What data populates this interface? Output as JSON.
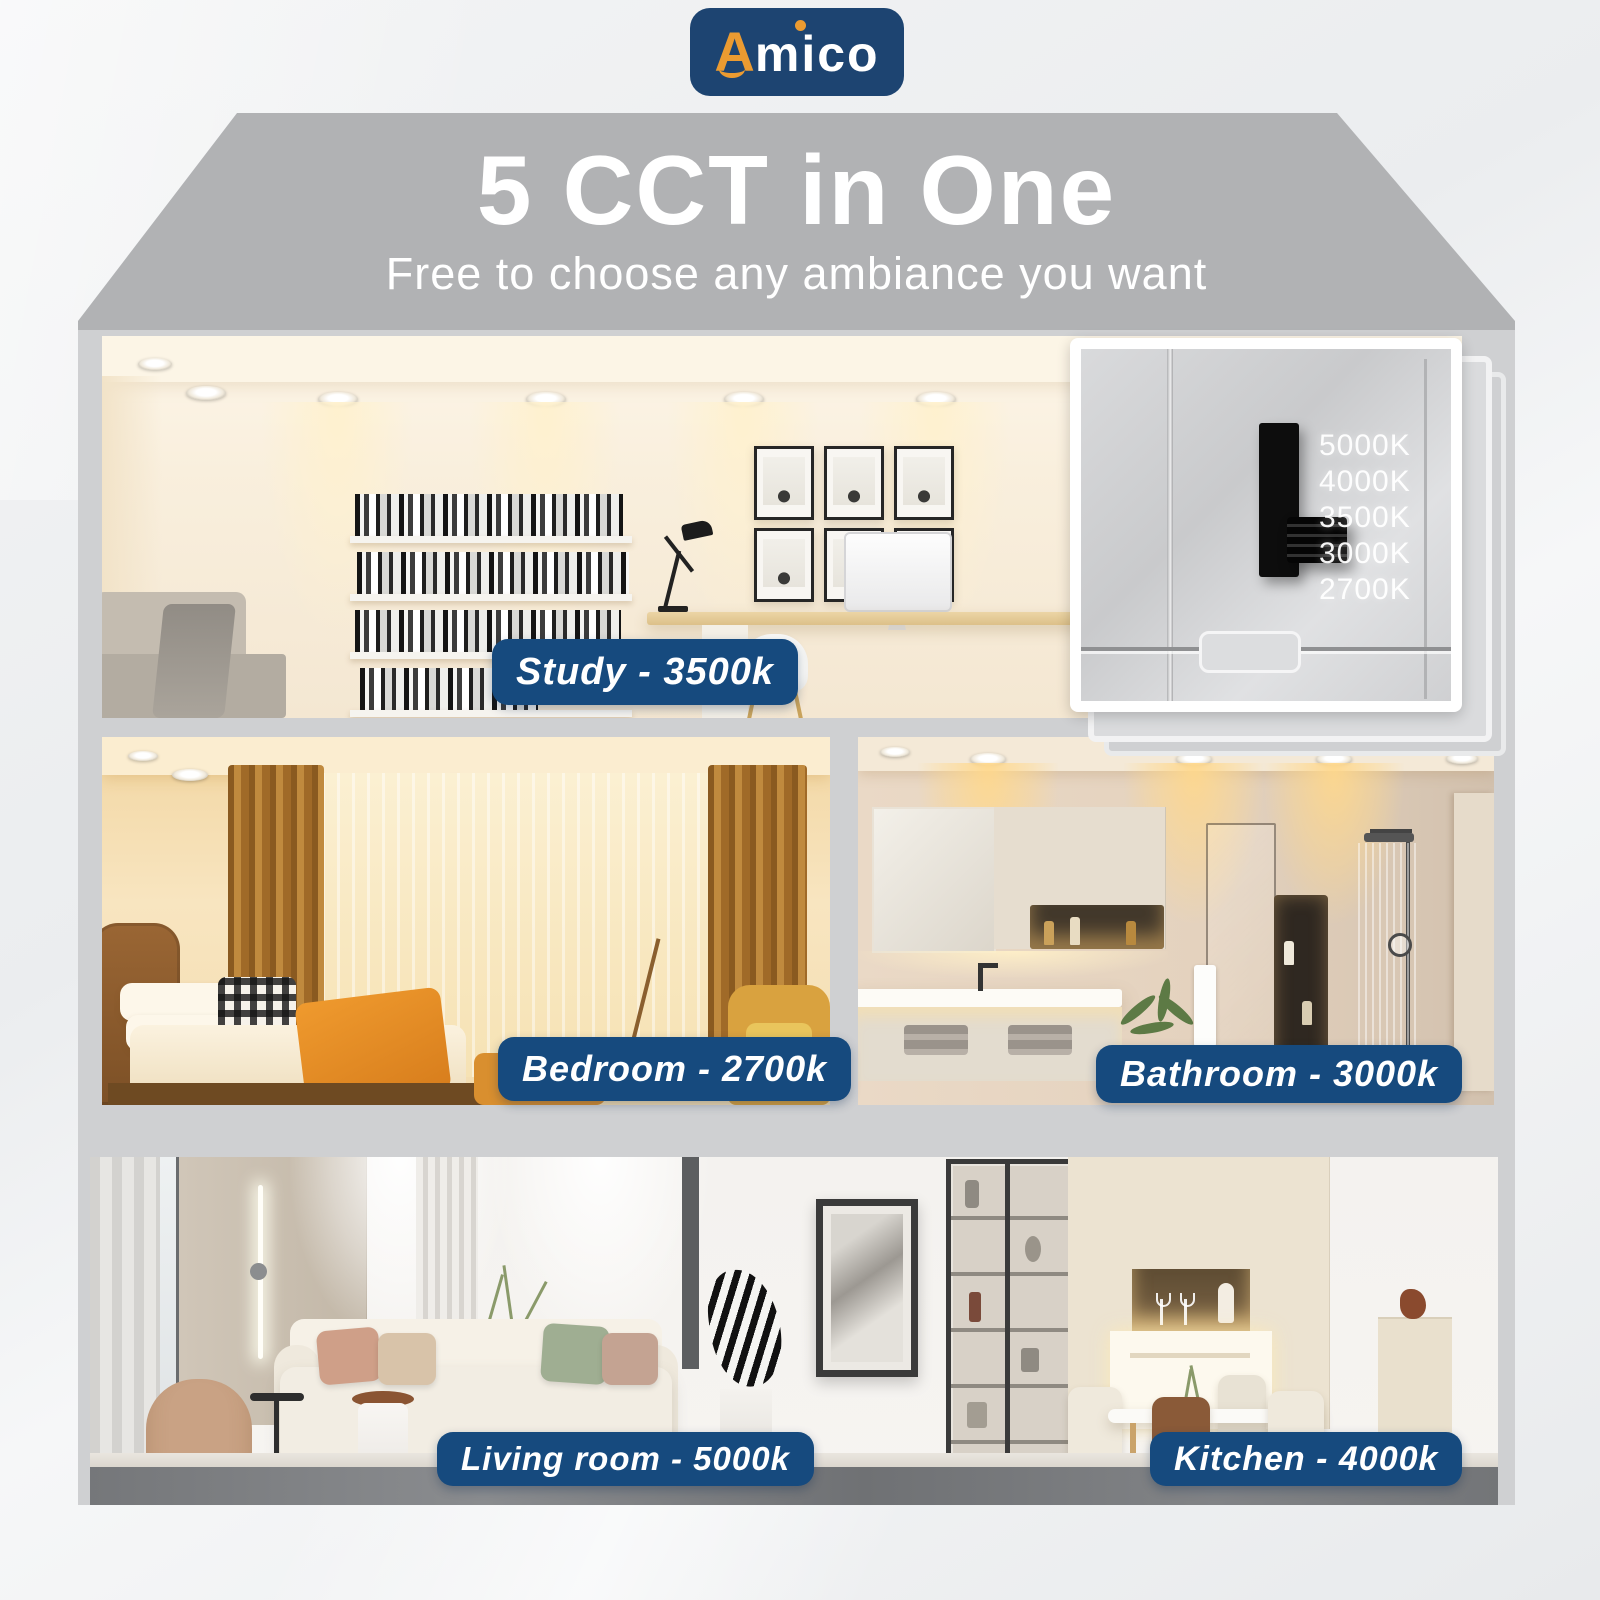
{
  "brand": {
    "name": "Amico",
    "logo_first_letter": "A",
    "logo_rest": "mico"
  },
  "header": {
    "title": "5 CCT in One",
    "subtitle": "Free to choose any ambiance you want"
  },
  "cct_switch": {
    "options": [
      "5000K",
      "4000K",
      "3500K",
      "3000K",
      "2700K"
    ],
    "selected": "3000K"
  },
  "rooms": [
    {
      "id": "study",
      "name": "Study",
      "cct": "3500k",
      "label": "Study - 3500k"
    },
    {
      "id": "bedroom",
      "name": "Bedroom",
      "cct": "2700k",
      "label": "Bedroom - 2700k"
    },
    {
      "id": "bathroom",
      "name": "Bathroom",
      "cct": "3000k",
      "label": "Bathroom - 3000k"
    },
    {
      "id": "living_room",
      "name": "Living room",
      "cct": "5000k",
      "label": "Living room - 5000k"
    },
    {
      "id": "kitchen",
      "name": "Kitchen",
      "cct": "4000k",
      "label": "Kitchen - 4000k"
    }
  ],
  "colors": {
    "badge_navy": "#164A7E",
    "logo_navy": "#1D4471",
    "accent_orange": "#EB9B31",
    "roof_gray": "#B1B2B4",
    "wall_gray": "#CFD0D2"
  }
}
